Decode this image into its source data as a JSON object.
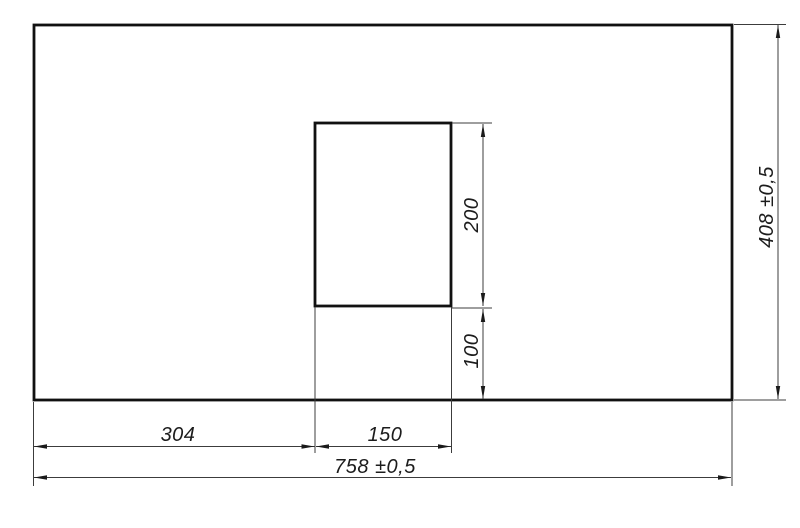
{
  "colors": {
    "background": "#ffffff",
    "outline": "#111111",
    "dimension_line": "#3c3c3c",
    "text": "#1c1c1c"
  },
  "dims": {
    "offset_left": {
      "label": "304",
      "value": 304
    },
    "cutout_width": {
      "label": "150",
      "value": 150
    },
    "overall_width": {
      "label": "758 ±0,5",
      "value": 758,
      "tolerance": "±0,5"
    },
    "cutout_height": {
      "label": "200",
      "value": 200
    },
    "offset_bottom": {
      "label": "100",
      "value": 100
    },
    "overall_height": {
      "label": "408 ±0,5",
      "value": 408,
      "tolerance": "±0,5"
    }
  }
}
